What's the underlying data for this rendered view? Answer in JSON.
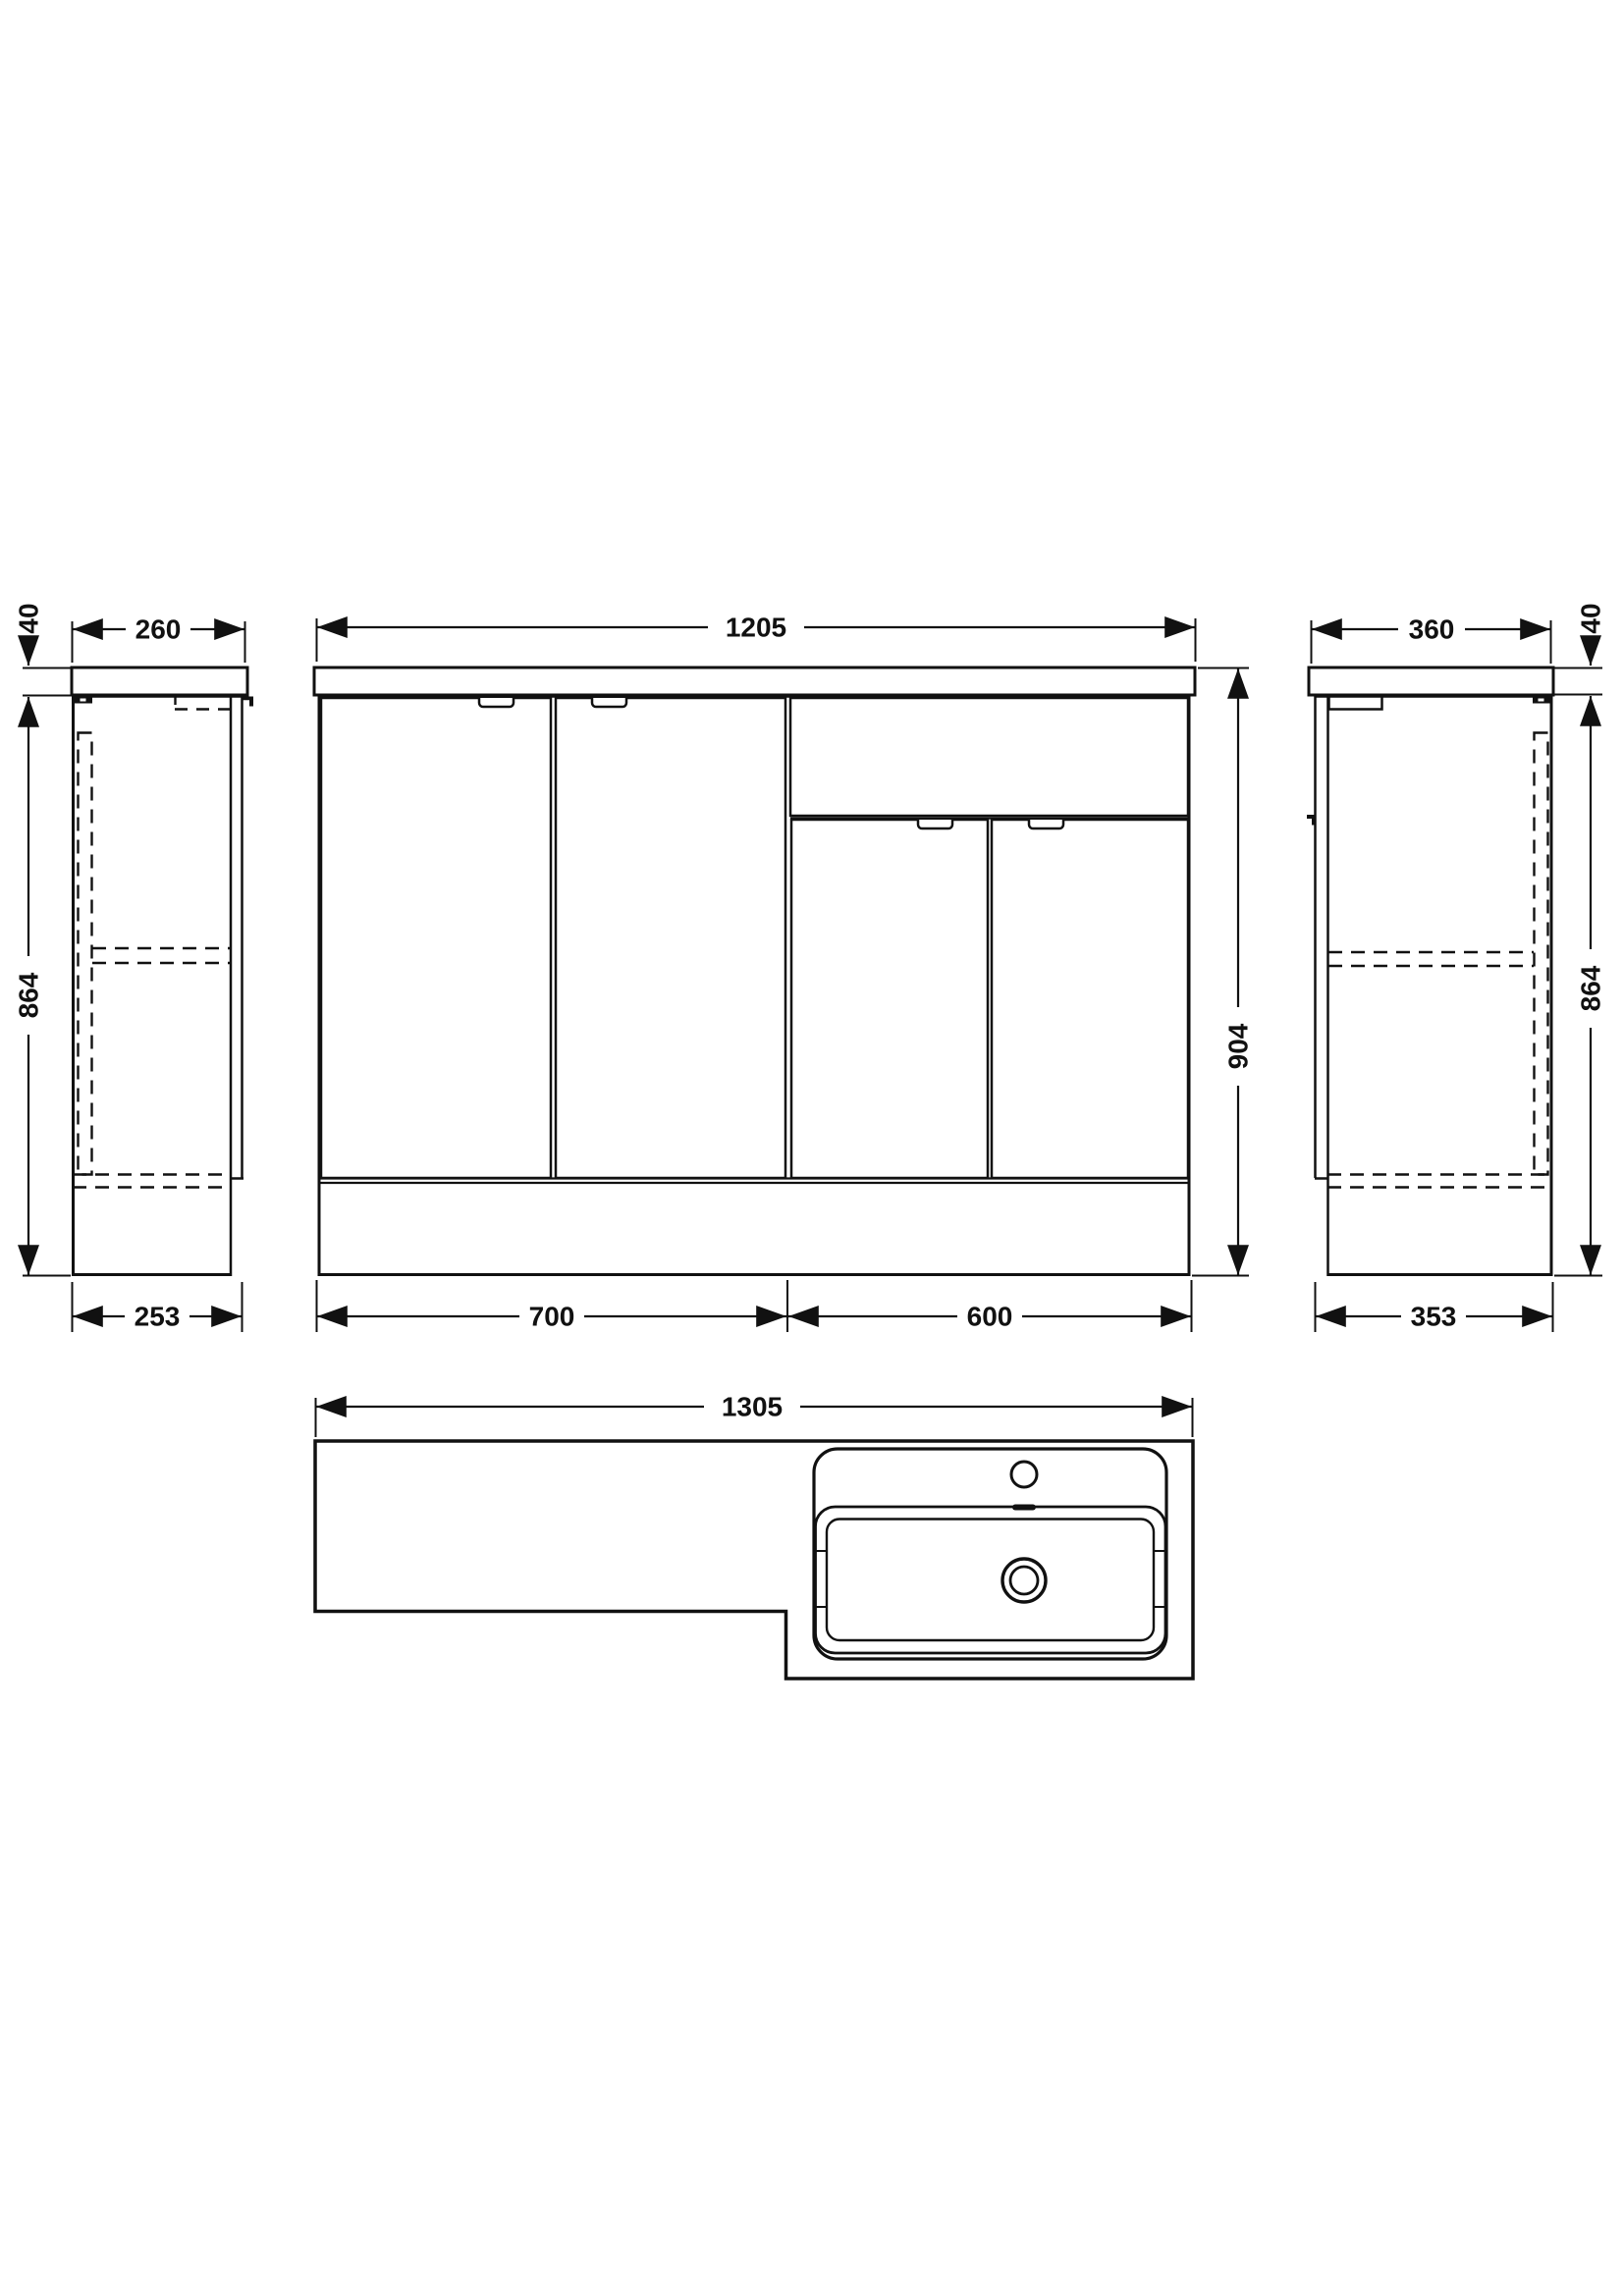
{
  "drawing": {
    "type": "technical-dimension-drawing",
    "subject": "L-shaped combination vanity unit with basin",
    "line_color": "#111111",
    "background_color": "#ffffff"
  },
  "dims": {
    "left_counter_thickness": "40",
    "left_top_depth": "260",
    "left_height": "864",
    "left_bottom_depth": "253",
    "front_width": "1205",
    "front_height": "904",
    "front_left_unit_width": "700",
    "front_right_unit_width": "600",
    "right_top_depth": "360",
    "right_counter_thickness": "40",
    "right_height": "864",
    "right_bottom_depth": "353",
    "plan_width": "1305"
  }
}
